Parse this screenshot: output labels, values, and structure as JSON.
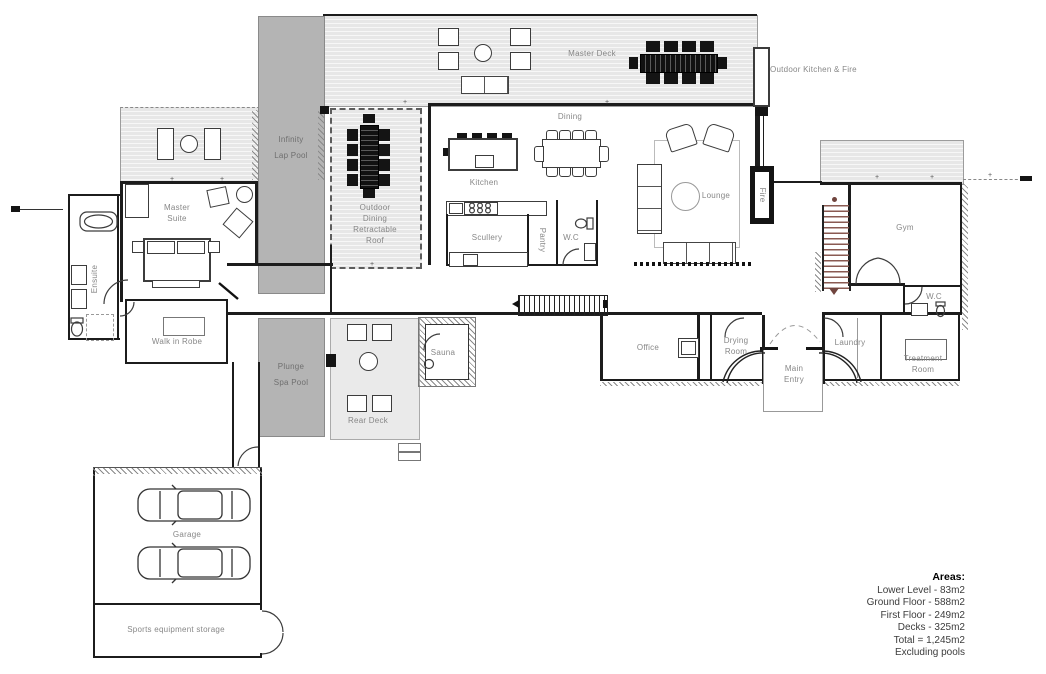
{
  "labels": {
    "master_deck": "Master Deck",
    "outdoor_kitchen_fire": "Outdoor Kitchen & Fire",
    "infinity_pool": "Infinity\nLap Pool",
    "outdoor_dining": "Outdoor\nDining\nRetractable\nRoof",
    "dining": "Dining",
    "kitchen": "Kitchen",
    "lounge": "Lounge",
    "scullery": "Scullery",
    "pantry": "Pantry",
    "wc_main": "W.C",
    "fire": "Fire",
    "gym": "Gym",
    "wc_gym": "W.C",
    "master_suite": "Master\nSuite",
    "ensuite": "Ensuite",
    "walk_in_robe": "Walk in Robe",
    "plunge_pool": "Plunge\nSpa Pool",
    "rear_deck": "Rear Deck",
    "sauna": "Sauna",
    "office": "Office",
    "drying_room": "Drying\nRoom",
    "main_entry": "Main\nEntry",
    "laundry": "Laundry",
    "treatment_room": "Treatment\nRoom",
    "garage": "Garage",
    "sports_storage": "Sports equipment storage"
  },
  "areas": {
    "title": "Areas:",
    "lines": [
      "Lower Level - 83m2",
      "Ground Floor - 588m2",
      "First Floor - 249m2",
      "Decks - 325m2",
      "Total = 1,245m2",
      "Excluding pools"
    ]
  },
  "colors": {
    "wall": "#1c1c1c",
    "deck_board": "#e7e7e7",
    "pool": "#b4b4b4",
    "rear_deck": "#eaeaea",
    "label_text": "#878787",
    "stair_accent": "#8a5a52"
  }
}
